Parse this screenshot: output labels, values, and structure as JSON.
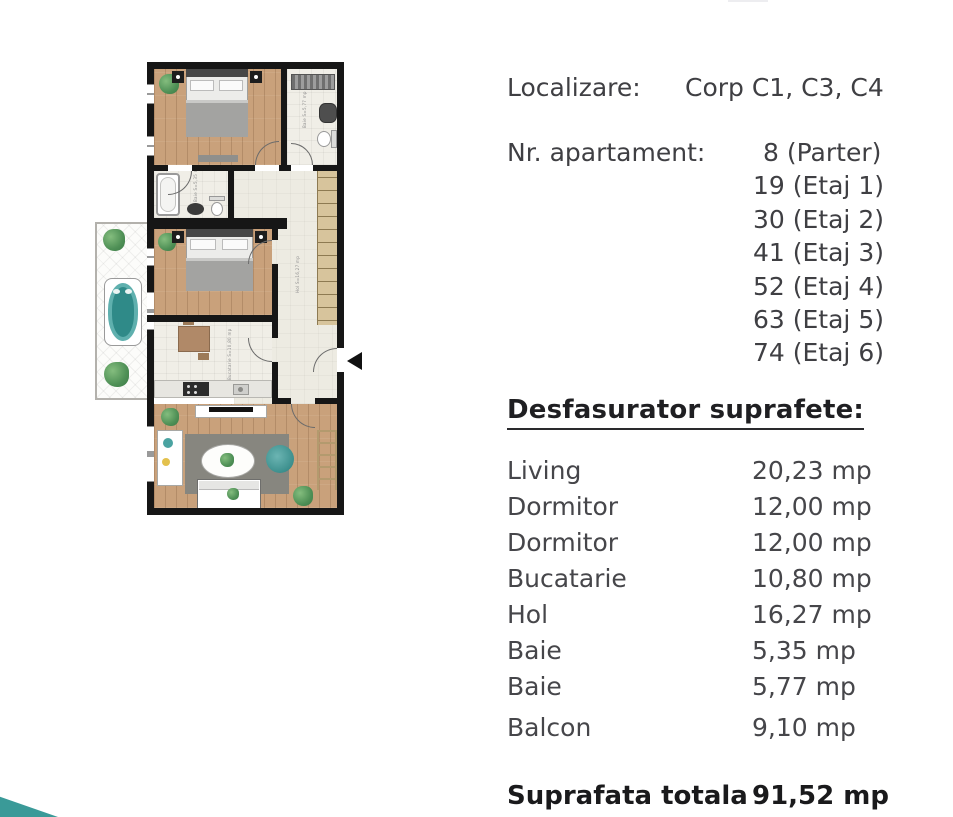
{
  "panel": {
    "localizare": {
      "label": "Localizare:",
      "value": "Corp C1, C3, C4"
    },
    "apartament": {
      "label": "Nr. apartament:",
      "list": [
        "8 (Parter)",
        "19 (Etaj 1)",
        "30 (Etaj 2)",
        "41 (Etaj 3)",
        "52 (Etaj 4)",
        "63 (Etaj 5)",
        "74 (Etaj 6)"
      ]
    },
    "heading": "Desfasurator suprafete:",
    "table": [
      {
        "label": "Living",
        "value": "20,23 mp"
      },
      {
        "label": "Dormitor",
        "value": "12,00 mp"
      },
      {
        "label": "Dormitor",
        "value": "12,00 mp"
      },
      {
        "label": "Bucatarie",
        "value": "10,80 mp"
      },
      {
        "label": "Hol",
        "value": "16,27 mp"
      },
      {
        "label": "Baie",
        "value": "5,35 mp"
      },
      {
        "label": "Baie",
        "value": "5,77 mp"
      },
      {
        "label": "Balcon",
        "value": "9,10 mp"
      }
    ],
    "total": {
      "label": "Suprafata totala",
      "value": "91,52 mp"
    }
  },
  "floorplan": {
    "annotations": [
      "Baie S=5,77 mp",
      "Baie S=5,35 mp",
      "Bucatarie S=10,80 mp",
      "Hol S=16,27 mp"
    ]
  },
  "colors": {
    "accent_teal": "#3a9a98",
    "wall": "#161616",
    "text_dark": "#1a1a1c",
    "text_gray": "#46464a"
  }
}
